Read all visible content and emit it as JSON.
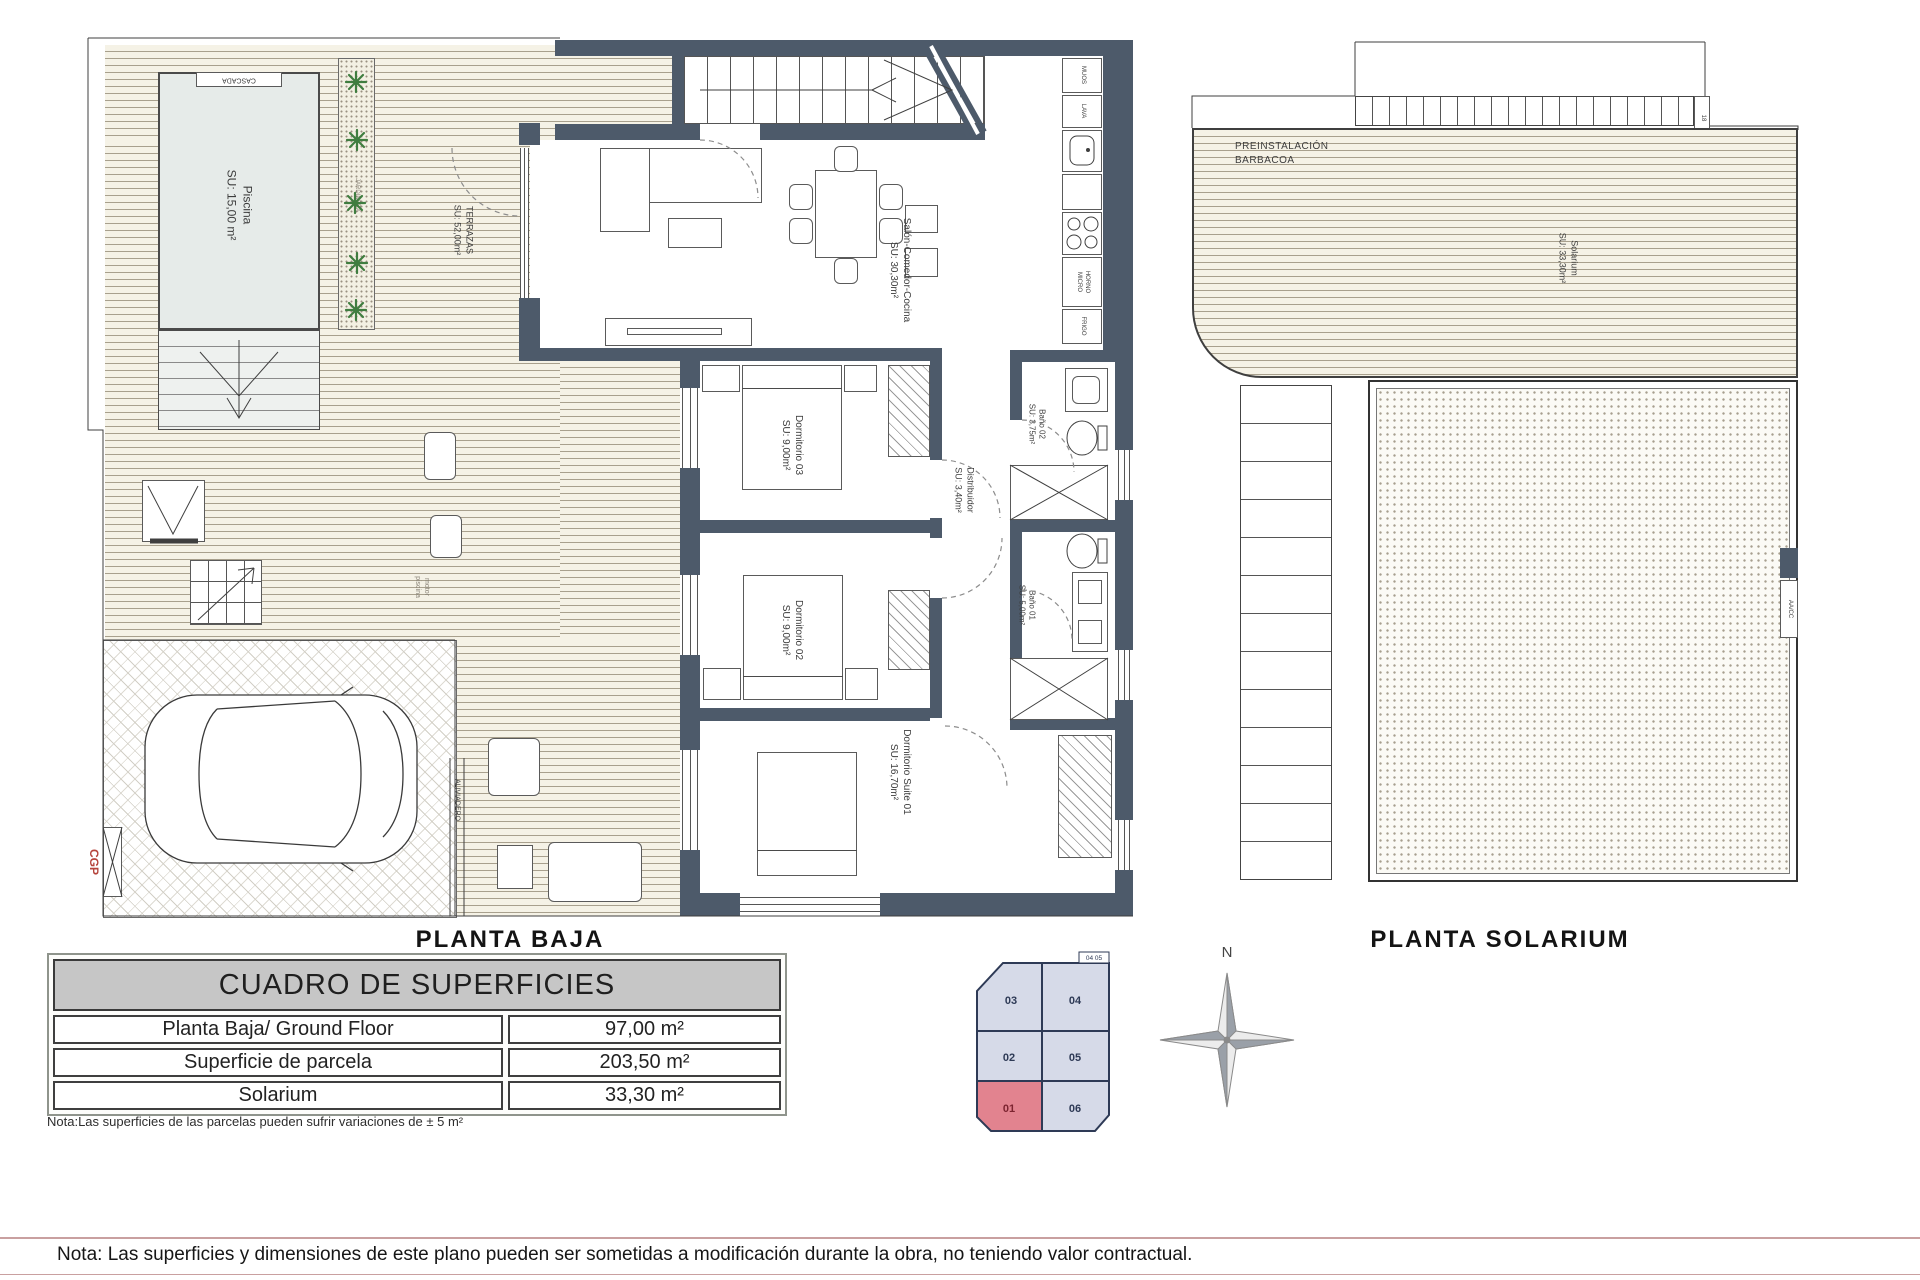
{
  "ground": {
    "title": "PLANTA BAJA",
    "cascada": "CASCADA",
    "piscina": {
      "name": "Piscina",
      "area": "SU: 15,00 m²"
    },
    "jardinera": "JARDINERA",
    "terrazas": {
      "name": "TERRAZAS",
      "area": "SU: 52,00m²"
    },
    "salon": {
      "name": "Salón-Comedor-Cocina",
      "area": "SU: 30,30m²"
    },
    "dorm03": {
      "name": "Dormitorio 03",
      "area": "SU: 9,00m²"
    },
    "dorm02": {
      "name": "Dormitorio 02",
      "area": "SU: 9,00m²"
    },
    "suite": {
      "name": "Dormitorio Suite 01",
      "area": "SU: 16,70m²"
    },
    "distribuidor": {
      "name": "Distribuidor",
      "area": "SU: 3,40m²"
    },
    "bano02": {
      "name": "Baño 02",
      "area": "SU: 3,75m²"
    },
    "bano01": {
      "name": "Baño 01",
      "area": "SU: 5,00m²"
    },
    "motor": {
      "line1": "motor",
      "line2": "piscina"
    },
    "aliviadero": "ALIVIADERO",
    "cgp": "CGP",
    "kitchen": {
      "top1": "MUOS",
      "top2": "LAVA",
      "oven1": "HORNO",
      "oven2": "MICRO",
      "fridge": "FRIGO"
    }
  },
  "solarium": {
    "title": "PLANTA SOLARIUM",
    "barbacoa1": "PREINSTALACIÓN",
    "barbacoa2": "BARBACOA",
    "label": {
      "name": "Solarium",
      "area": "SU: 33,30m²"
    },
    "aacc": "AA/CC",
    "step": "18"
  },
  "surfaces_table": {
    "title": "CUADRO DE SUPERFICIES",
    "rows": [
      {
        "label": "Planta Baja/ Ground Floor",
        "value": "97,00 m²"
      },
      {
        "label": "Superficie de parcela",
        "value": "203,50 m²"
      },
      {
        "label": "Solarium",
        "value": "33,30 m²"
      }
    ],
    "note": "Nota:Las superficies de las parcelas pueden sufrir variaciones de ± 5 m²"
  },
  "plot": {
    "n03": "03",
    "n04": "04",
    "n02": "02",
    "n05": "05",
    "n01": "01",
    "n06": "06",
    "tiny": "04 05",
    "parcel_color": "#d6dae8",
    "highlight_color": "#e2838f"
  },
  "compass": {
    "north": "N"
  },
  "footer": {
    "note": "Nota: Las superficies y dimensiones de este plano pueden ser sometidas a modificación durante la obra, no teniendo valor contractual."
  },
  "colors": {
    "wall": "#4d5a6a",
    "accent_red": "#b5443c"
  }
}
